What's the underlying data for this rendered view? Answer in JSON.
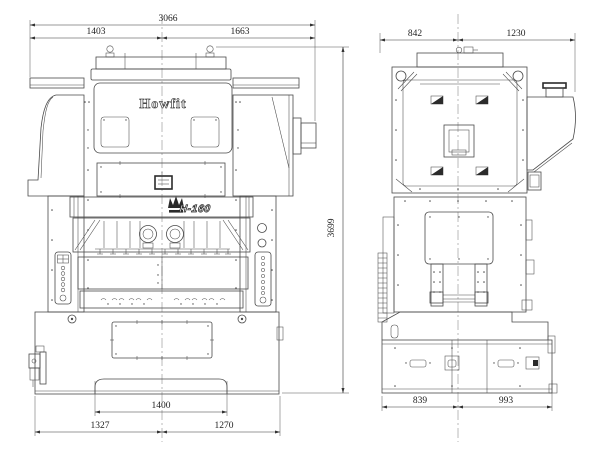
{
  "brand": {
    "name": "Howfit",
    "model": "H-160"
  },
  "front_view": {
    "dim_total_width": "3066",
    "dim_left": "1403",
    "dim_right": "1663",
    "dim_height": "3699",
    "dim_opening": "1400",
    "dim_base_left": "1327",
    "dim_base_right": "1270"
  },
  "side_view": {
    "dim_top_left": "842",
    "dim_top_right": "1230",
    "dim_base_left": "839",
    "dim_base_right": "993"
  },
  "colors": {
    "line": "#4a4a4a",
    "dimension": "#333333",
    "accent_dark": "#2b2b2b",
    "background": "#ffffff"
  }
}
